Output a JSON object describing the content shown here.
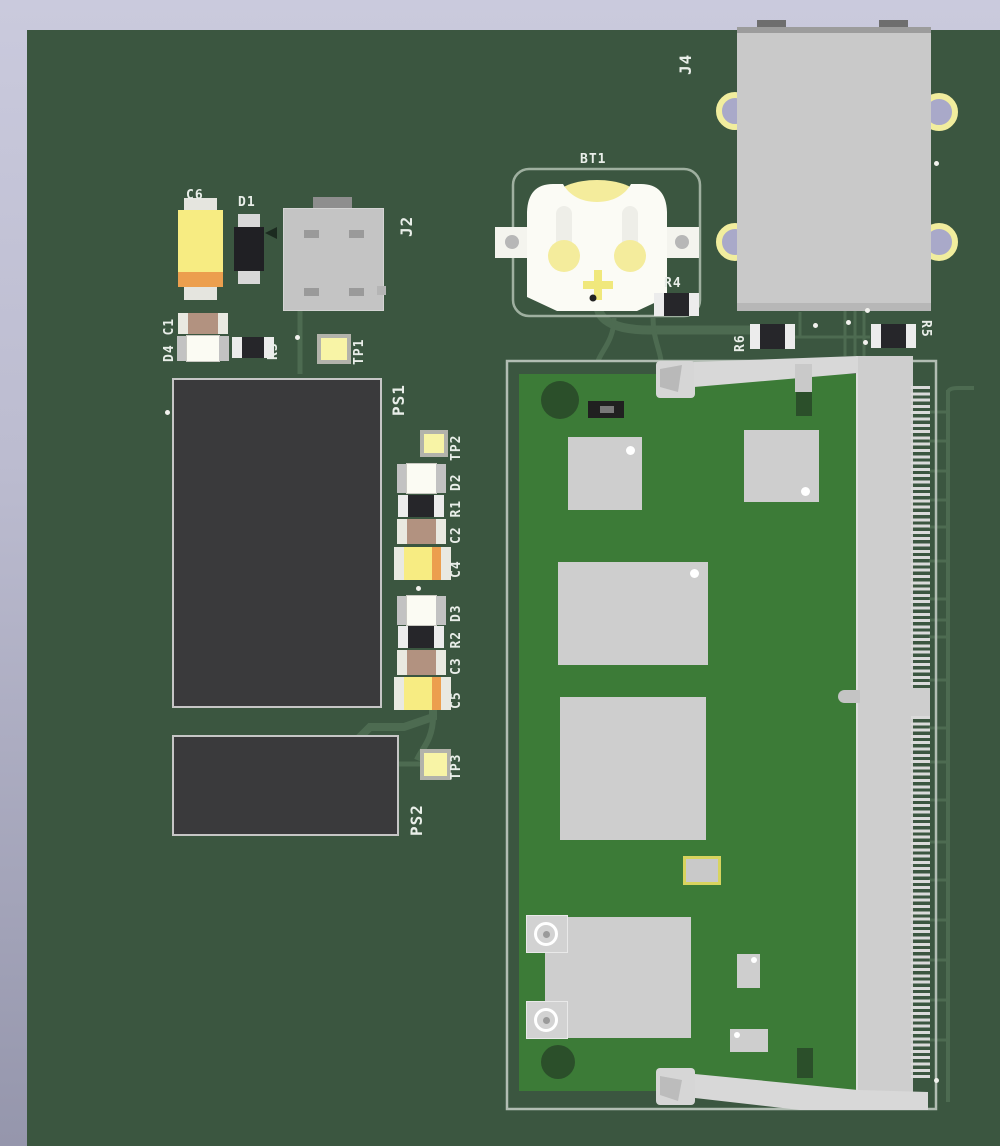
{
  "labels": {
    "c6": "C6",
    "d1": "D1",
    "j2": "J2",
    "d4_c1": "D4 C1",
    "r3": "R3",
    "tp1": "TP1",
    "ps1": "PS1",
    "tp2": "TP2",
    "c2_r1_d2": "C2 R1 D2",
    "c4": "C4",
    "c3_r2_d3": "C3 R2 D3",
    "c5": "C5",
    "ps2": "PS2",
    "tp3": "TP3",
    "bt1": "BT1",
    "r4": "R4",
    "r6": "R6",
    "r5": "R5",
    "j4": "J4"
  },
  "colors": {
    "background_top": "#cacadd",
    "background_bottom": "#9596ac",
    "board_green": "#3b5640",
    "module_green": "#3c7b37",
    "trace_green": "#4d6b51",
    "silkscreen_white": "#e9eee9",
    "component_gray": "#c9c9c9",
    "power_module_dark": "#3a3a3c",
    "tantalum_yellow": "#f7ec82",
    "tantalum_stripe_orange": "#ec9f4e",
    "testpoint_yellow": "#f8f4a6",
    "pad_ring_gold": "#f1ed9e",
    "hole_lavender": "#a9a9c9",
    "battery_yellow": "#f4ec9c"
  }
}
